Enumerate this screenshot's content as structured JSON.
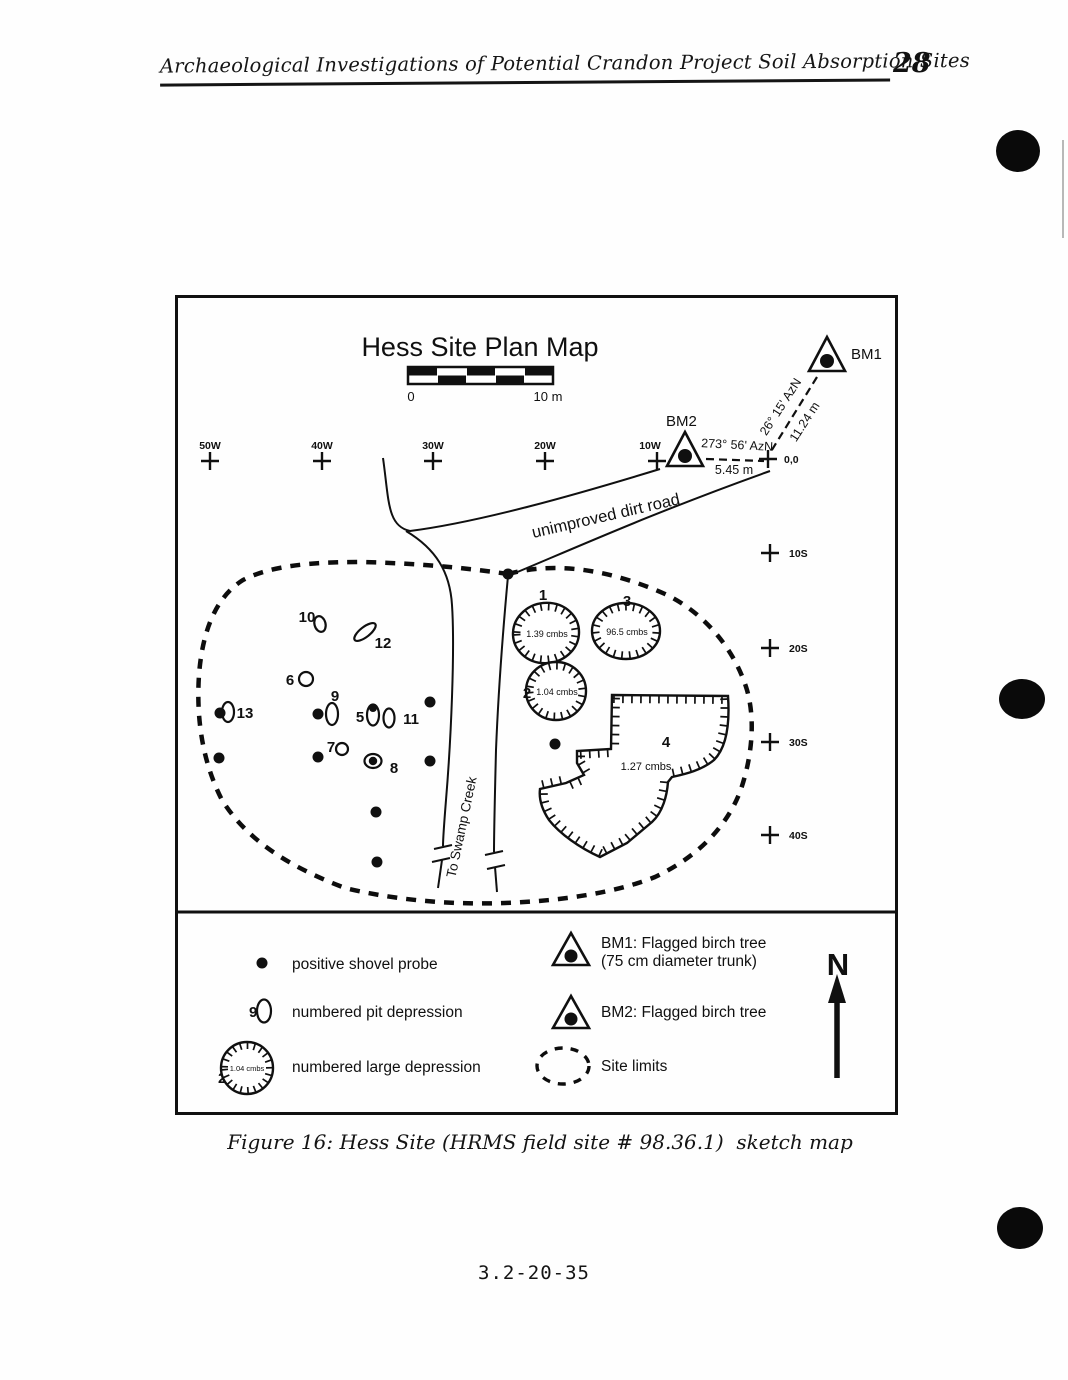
{
  "header": {
    "title": "Archaeological Investigations of Potential Crandon Project Soil Absorption Sites",
    "page_number": "28"
  },
  "map": {
    "title": "Hess Site Plan Map",
    "scale": {
      "left_label": "0",
      "right_label": "10 m"
    },
    "grid_west": [
      "50W",
      "40W",
      "30W",
      "20W",
      "10W"
    ],
    "grid_south": [
      "10S",
      "20S",
      "30S",
      "40S"
    ],
    "datum_label": "0,0",
    "benchmarks": [
      {
        "id": "BM1",
        "azimuth": "26° 15' AzN",
        "distance": "11.24 m"
      },
      {
        "id": "BM2",
        "azimuth": "273° 56' AzN",
        "distance": "5.45 m"
      }
    ],
    "road_label": "unimproved dirt road",
    "creek_label": "To Swamp Creek",
    "large_depressions": [
      {
        "number": "1",
        "depth": "1.39 cmbs"
      },
      {
        "number": "2",
        "depth": "1.04 cmbs"
      },
      {
        "number": "3",
        "depth": "96.5 cmbs"
      },
      {
        "number": "4",
        "depth": "1.27 cmbs"
      }
    ],
    "pit_numbers": [
      "5",
      "6",
      "7",
      "8",
      "9",
      "10",
      "11",
      "12",
      "13"
    ]
  },
  "legend": {
    "items": [
      {
        "label": "positive shovel probe"
      },
      {
        "number": "9",
        "label": "numbered pit depression"
      },
      {
        "number": "2",
        "inner_text": "1.04 cmbs",
        "label": "numbered large depression"
      },
      {
        "label": "BM1: Flagged birch tree",
        "label2": "(75 cm diameter trunk)"
      },
      {
        "label": "BM2: Flagged birch tree"
      },
      {
        "label": "Site limits"
      }
    ],
    "north_label": "N"
  },
  "caption": "Figure 16: Hess Site (HRMS field site # 98.36.1)  sketch map",
  "footer": "3.2-20-35"
}
